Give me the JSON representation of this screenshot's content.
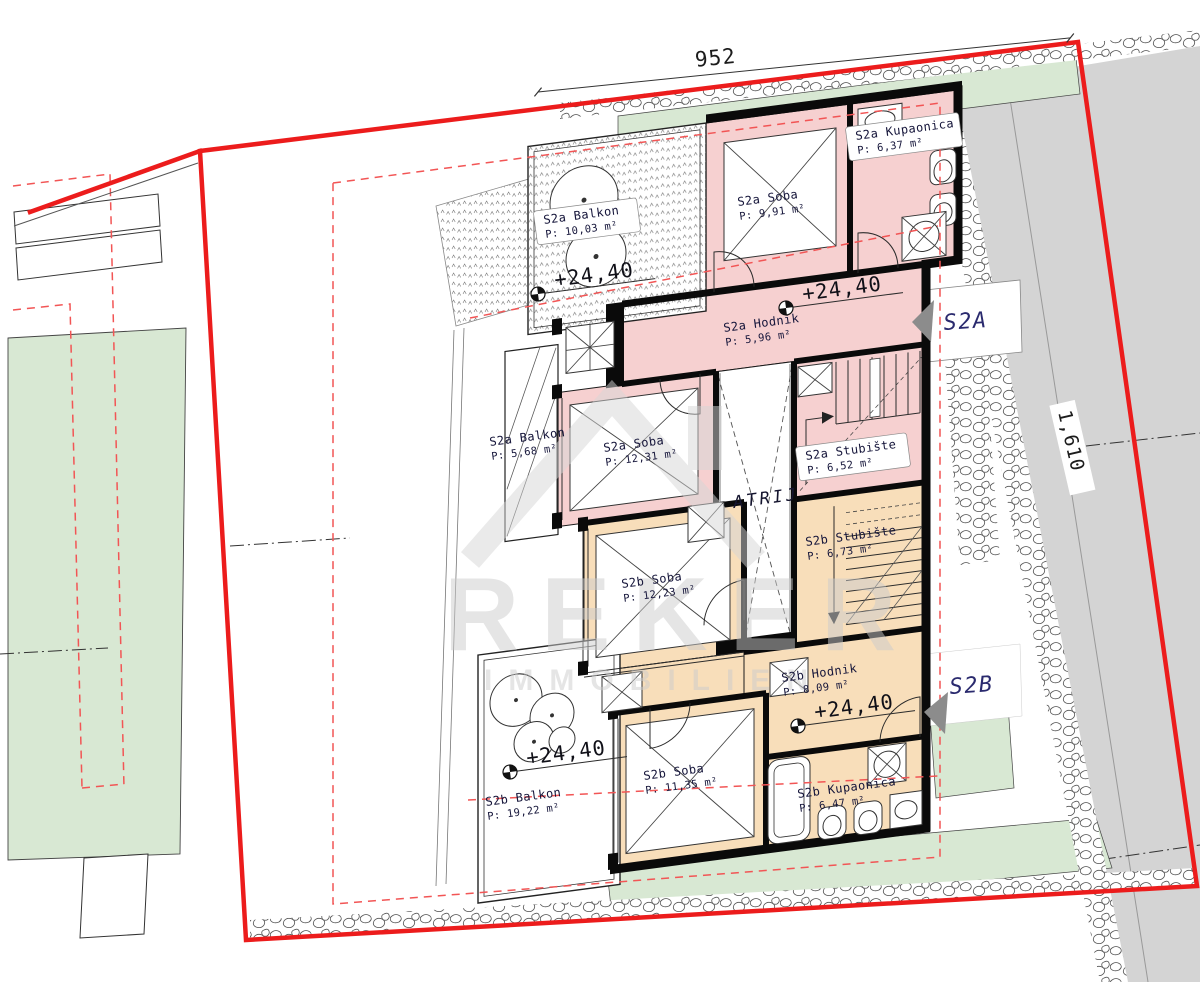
{
  "plan": {
    "dimensions": {
      "top": "952",
      "side": "1,610"
    },
    "elevation": "+24,40",
    "atrium": "ATRIJ",
    "units": [
      {
        "label": "S2A"
      },
      {
        "label": "S2B"
      }
    ],
    "rooms": [
      {
        "id": "s2a-kupaonica",
        "name": "S2a Kupaonica",
        "area": "P: 6,37 m²"
      },
      {
        "id": "s2a-soba-1",
        "name": "S2a Soba",
        "area": "P: 9,91 m²"
      },
      {
        "id": "s2a-balkon-1",
        "name": "S2a Balkon",
        "area": "P: 10,03 m²"
      },
      {
        "id": "s2a-hodnik",
        "name": "S2a Hodnik",
        "area": "P: 5,96 m²"
      },
      {
        "id": "s2a-soba-2",
        "name": "S2a Soba",
        "area": "P: 12,31 m²"
      },
      {
        "id": "s2a-balkon-2",
        "name": "S2a Balkon",
        "area": "P: 5,68 m²"
      },
      {
        "id": "s2a-stubiste",
        "name": "S2a Stubište",
        "area": "P: 6,52 m²"
      },
      {
        "id": "s2b-stubiste",
        "name": "S2b Stubište",
        "area": "P: 6,73 m²"
      },
      {
        "id": "s2b-soba-1",
        "name": "S2b Soba",
        "area": "P: 12,23 m²"
      },
      {
        "id": "s2b-hodnik",
        "name": "S2b Hodnik",
        "area": "P: 8,09 m²"
      },
      {
        "id": "s2b-soba-2",
        "name": "S2b Soba",
        "area": "P: 11,35 m²"
      },
      {
        "id": "s2b-kupaonica",
        "name": "S2b Kupaonica",
        "area": "P: 6,47 m²"
      },
      {
        "id": "s2b-balkon",
        "name": "S2b Balkon",
        "area": "P: 19,22 m²"
      }
    ],
    "watermark": {
      "brand": "REKER",
      "sub": "IMMOBILIEN"
    },
    "colors": {
      "boundary_red": "#ec1c1c",
      "dashed_red": "#f25555",
      "apartment_s2a": "#f6d0d0",
      "apartment_s2b": "#f8deba",
      "lawn_green": "#d8e8d3",
      "road_gray": "#d4d4d4",
      "marker_navy": "#2a2a6e",
      "label_ink": "#15153a"
    }
  }
}
